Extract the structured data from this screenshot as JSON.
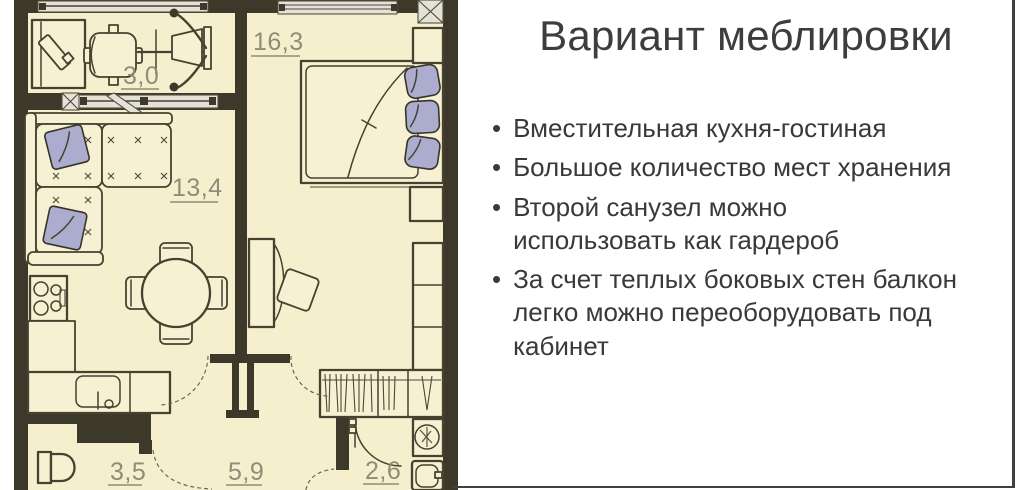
{
  "slide": {
    "title": "Вариант меблировки",
    "bullet_char": "•",
    "bullets": [
      "Вместительная кухня-гостиная",
      "Большое количество мест хранения",
      "Второй санузел можно\nиспользовать как гардероб",
      "За счет теплых боковых стен балкон\nлегко можно переоборудовать под\nкабинет"
    ]
  },
  "floorplan": {
    "rooms": {
      "balcony": {
        "area": "3,0"
      },
      "living": {
        "area": "13,4"
      },
      "bedroom": {
        "area": "16,3"
      },
      "bathroom": {
        "area": "3,5"
      },
      "hallway": {
        "area": "5,9"
      },
      "bathroom2": {
        "area": "2,6"
      }
    },
    "colors": {
      "floor": "#f6efce",
      "wall": "#3c392b",
      "furniture_line": "#47412f",
      "pillow": "#abacce",
      "window": "#e4e2d8",
      "label": "#8f8c77",
      "title_text": "#3e3d3b",
      "body_text": "#3a3936"
    }
  }
}
